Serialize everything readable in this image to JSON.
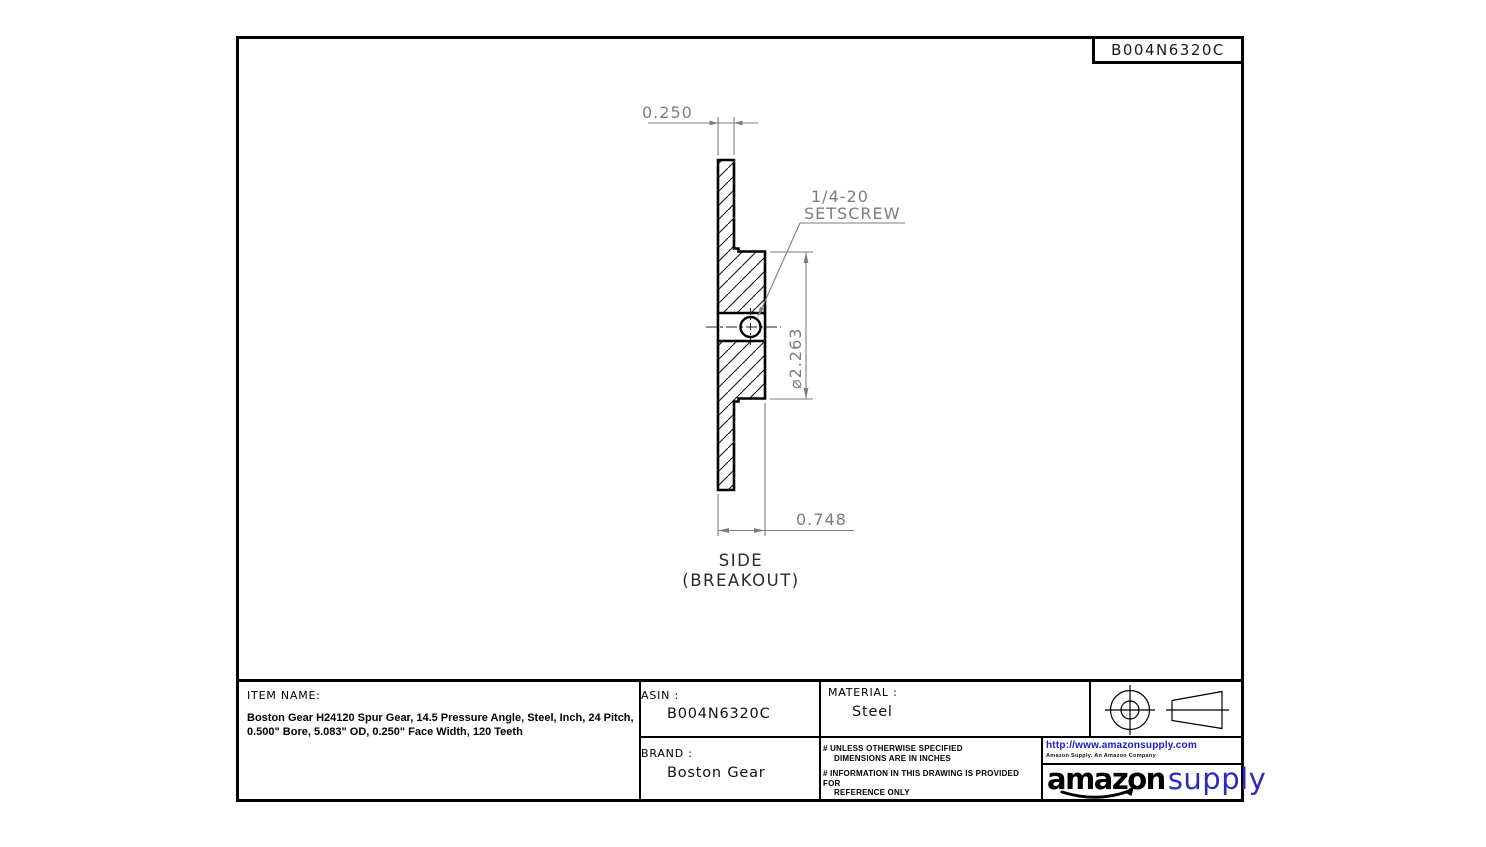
{
  "sheet": {
    "asin_plate": "B004N6320C"
  },
  "drawing": {
    "dims": {
      "face_width": "0.250",
      "overall_width": "0.748",
      "hub_diameter": "⌀2.263"
    },
    "setscrew": {
      "line1": "1/4-20",
      "line2": "SETSCREW"
    },
    "view_label": {
      "line1": "SIDE",
      "line2": "(BREAKOUT)"
    },
    "colors": {
      "dimension": "#7d7d7d",
      "outline": "#000000"
    }
  },
  "title_block": {
    "item_name": {
      "label": "ITEM NAME:",
      "line1": "Boston Gear H24120 Spur Gear, 14.5 Pressure Angle, Steel, Inch, 24 Pitch,",
      "line2": "0.500\" Bore, 5.083\" OD, 0.250\" Face Width, 120 Teeth"
    },
    "asin": {
      "label": "ASIN :",
      "value": "B004N6320C"
    },
    "material": {
      "label": "MATERIAL :",
      "value": "Steel"
    },
    "brand": {
      "label": "BRAND :",
      "value": "Boston Gear"
    },
    "notes": {
      "n1a": "# UNLESS OTHERWISE SPECIFIED",
      "n1b": "DIMENSIONS ARE IN INCHES",
      "n2a": "# INFORMATION IN THIS DRAWING IS PROVIDED FOR",
      "n2b": "REFERENCE ONLY"
    },
    "amazon": {
      "url": "http://www.amazonsupply.com",
      "tagline": "Amazon Supply. An Amazon Company",
      "logo_black": "amazon",
      "logo_blue": "supply",
      "link_color": "#1a1acd",
      "supply_color": "#2b2bbd"
    }
  }
}
